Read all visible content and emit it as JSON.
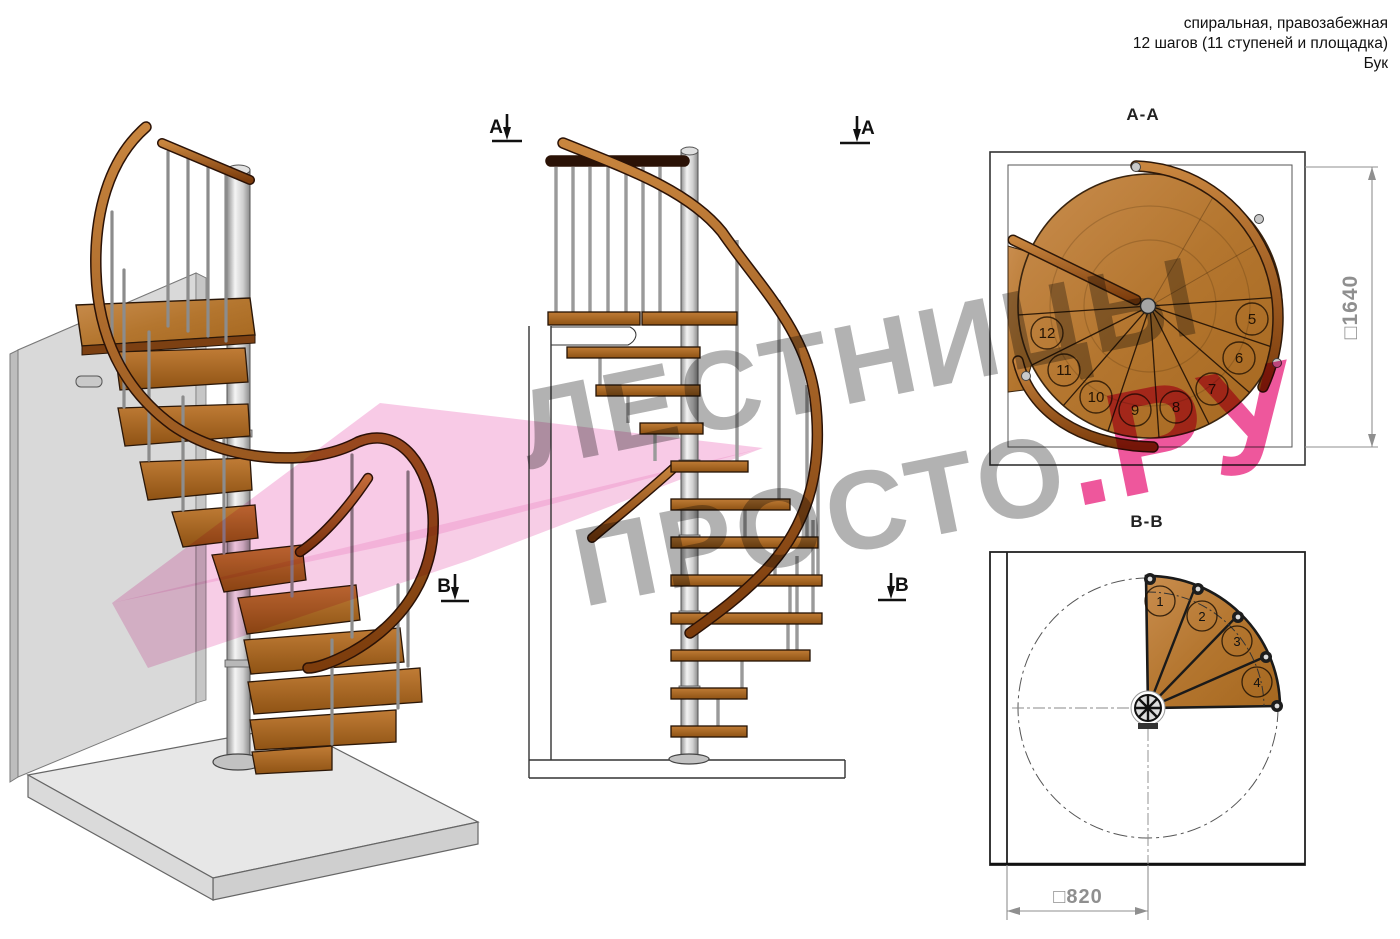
{
  "header": {
    "line1": "спиральная, правозабежная",
    "line2": "12 шагов (11 ступеней и площадка)",
    "line3": "Бук"
  },
  "watermark": {
    "line1": "ЛЕСТНИЦЫ",
    "line2_gray": "ПРОСТО",
    "line2_pink": ".РУ"
  },
  "sections": {
    "aa": {
      "title": "А-А",
      "marker_letter": "А",
      "dimension": "□1640",
      "steps": [
        "5",
        "6",
        "7",
        "8",
        "9",
        "10",
        "11",
        "12"
      ]
    },
    "bb": {
      "title": "В-В",
      "marker_letter": "В",
      "dimension": "□820",
      "steps": [
        "1",
        "2",
        "3",
        "4"
      ]
    }
  },
  "colors": {
    "wood_light": "#c68b4c",
    "wood_mid": "#b4762f",
    "wood_dark": "#96591d",
    "rail": "#a4561c",
    "metal": "#d4d4d4",
    "wall": "#d9d9d9",
    "pink_plane": "#f1a6d3",
    "watermark_gray": "#b2b2b2",
    "watermark_pink": "#ee579c",
    "dim_gray": "#8f8f8f"
  }
}
